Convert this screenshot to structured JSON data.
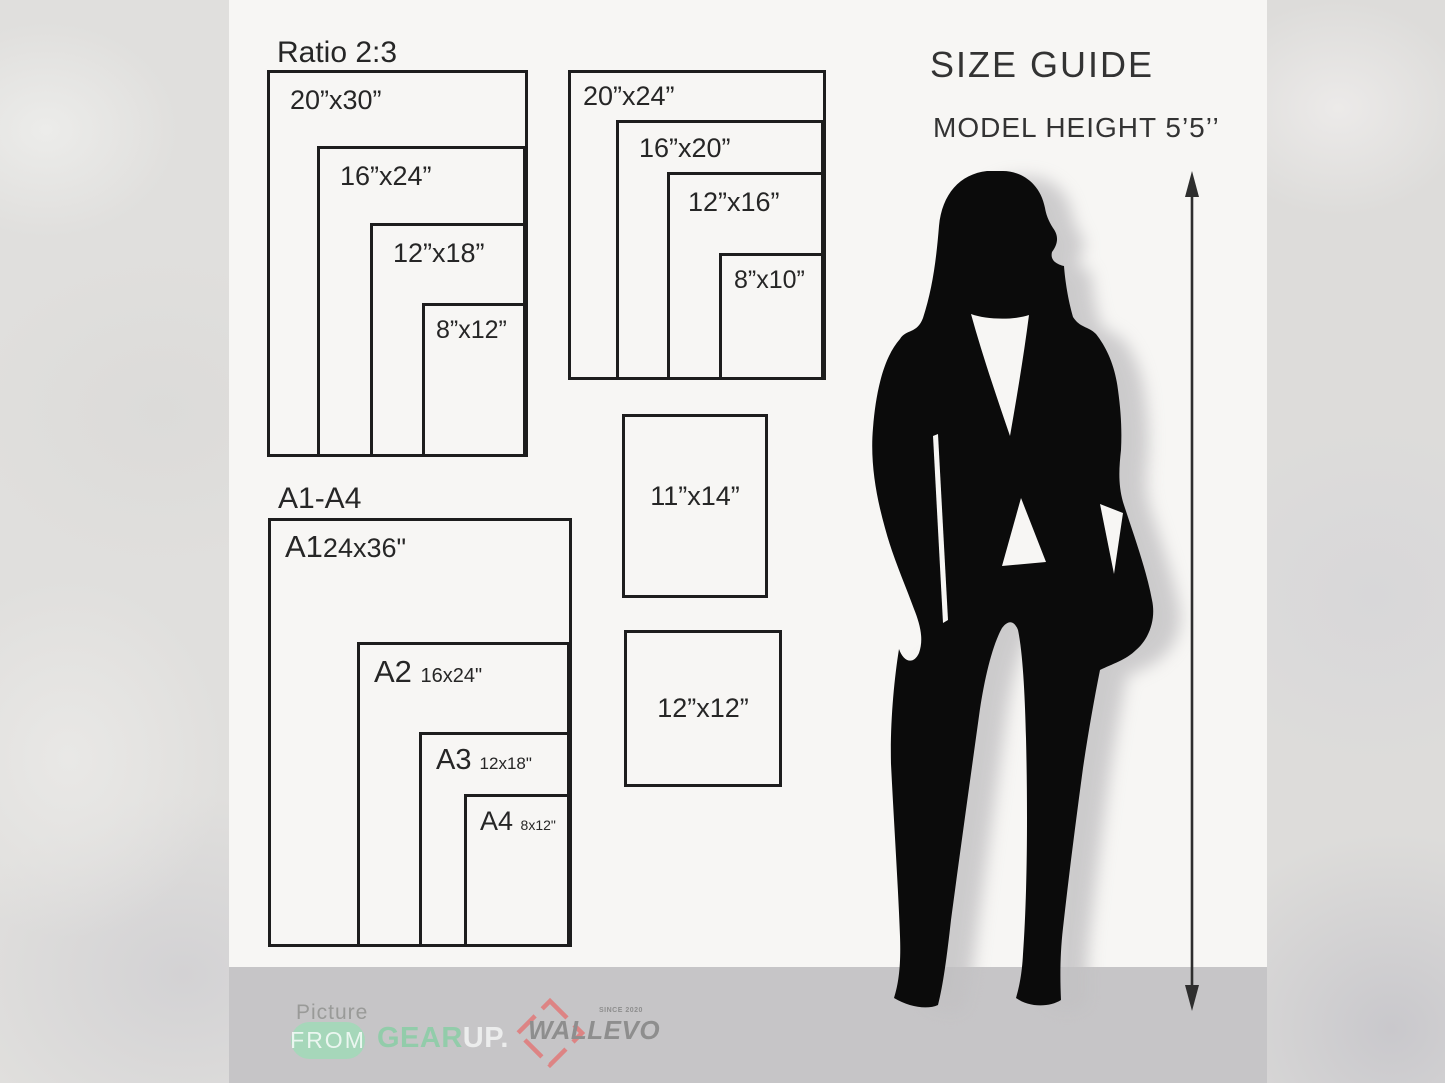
{
  "header": {
    "title": "SIZE GUIDE",
    "subtitle": "MODEL HEIGHT 5’5’’"
  },
  "groups": {
    "ratio_2_3": {
      "heading": "Ratio 2:3",
      "sizes": [
        "20”x30”",
        "16”x24”",
        "12”x18”",
        "8”x12”"
      ]
    },
    "standard": {
      "sizes": [
        "20”x24”",
        "16”x20”",
        "12”x16”",
        "8”x10”"
      ]
    },
    "a_series": {
      "heading": "A1-A4",
      "items": [
        {
          "code": "A1",
          "size": "24x36\""
        },
        {
          "code": "A2",
          "size": "16x24\""
        },
        {
          "code": "A3",
          "size": "12x18\""
        },
        {
          "code": "A4",
          "size": "8x12\""
        }
      ]
    },
    "singles": {
      "sizes": [
        "11”x14”",
        "12”x12”"
      ]
    }
  },
  "footer": {
    "picture_label": "Picture",
    "from_label": "FROM",
    "gear_label": "GEAR",
    "up_label": "UP.",
    "wallevo_label": "WALLEVO",
    "since_label": "SINCE 2020"
  },
  "colors": {
    "panel_bg": "#f7f6f4",
    "band_bg": "#c6c5c7",
    "ink": "#1d1d1d",
    "silhouette": "#0b0b0b",
    "mint": "#92ccaa",
    "pill_green": "#a6d7ba",
    "logo_red": "#dd8484",
    "logo_gray": "#8e8e8e"
  }
}
